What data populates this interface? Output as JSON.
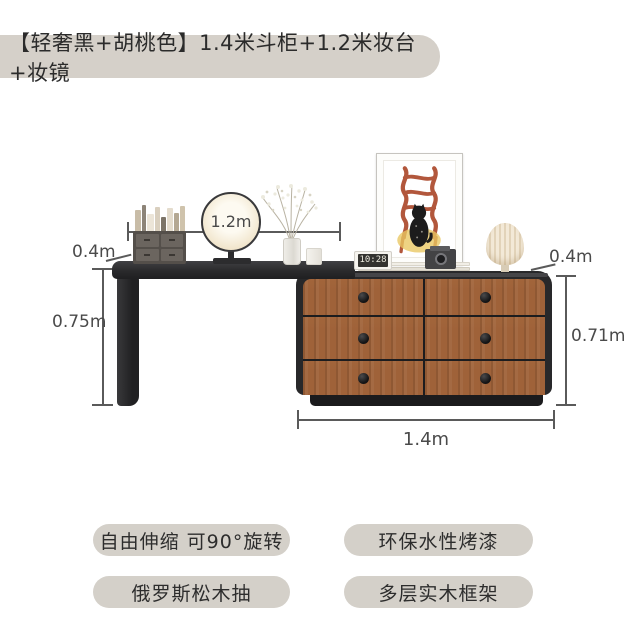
{
  "title_badge": {
    "text": "【轻奢黑+胡桃色】1.4米斗柜+1.2米妆台+妆镜"
  },
  "dimensions": {
    "vanity_width": "1.2m",
    "vanity_depth": "0.4m",
    "vanity_height": "0.75m",
    "dresser_depth": "0.4m",
    "dresser_height": "0.71m",
    "dresser_width": "1.4m"
  },
  "decor": {
    "clock_time": "10:28"
  },
  "features": [
    {
      "label": "自由伸缩 可90°旋转"
    },
    {
      "label": "环保水性烤漆"
    },
    {
      "label": "俄罗斯松木抽"
    },
    {
      "label": "多层实木框架"
    }
  ],
  "colors": {
    "badge_bg": "#d4d0c9",
    "wood": "#9f6239",
    "furniture_black": "#28282a",
    "dimension_lines": "#5a5a5a",
    "lamp_shade": "#eee3cf",
    "chair_art": "#b2573c"
  }
}
